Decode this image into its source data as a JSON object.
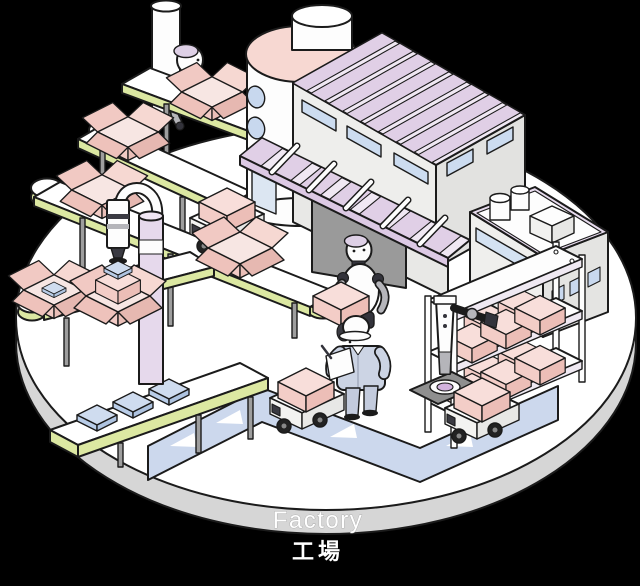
{
  "caption": {
    "en": "Factory",
    "ja": "工場"
  },
  "colors": {
    "background": "#000000",
    "outline": "#1b1b1b",
    "platform_top": "#ffffff",
    "platform_side": "#d6d6d6",
    "box_pink_light": "#f6d8d2",
    "box_pink_mid": "#f2cbc5",
    "box_pink_dark": "#eabfb8",
    "conveyor_lime": "#dce8a2",
    "roof_lavender": "#e0cfe6",
    "roof_light": "#f0e8f3",
    "window_blue": "#ccdcf0",
    "route_blue": "#ccd8ed",
    "package_blue": "#cfdcef",
    "silo_pink": "#f7d8d2",
    "pole_lavender": "#e6d9ec",
    "worker_uniform": "#ccd4e4",
    "worker_pants": "#c3cbdd",
    "robot_joint": "#33333b",
    "robot_gray": "#b5b5ba",
    "pad_purple": "#d2b2de",
    "leg_gray": "#9e9e9e",
    "door_gray": "#9a9a9a"
  },
  "scene": {
    "description": "Isometric smart-factory illustration on a circular platform",
    "objects": [
      "circular-platform",
      "tiered-conveyors",
      "cardboard-boxes",
      "loader-robot",
      "suction-arm-robot",
      "packing-conveyor",
      "silo-tank",
      "factory-building",
      "annex-building",
      "storage-rack",
      "mobile-arm-robot",
      "agv-route",
      "agv-carts",
      "humanoid-robot",
      "factory-worker"
    ]
  }
}
